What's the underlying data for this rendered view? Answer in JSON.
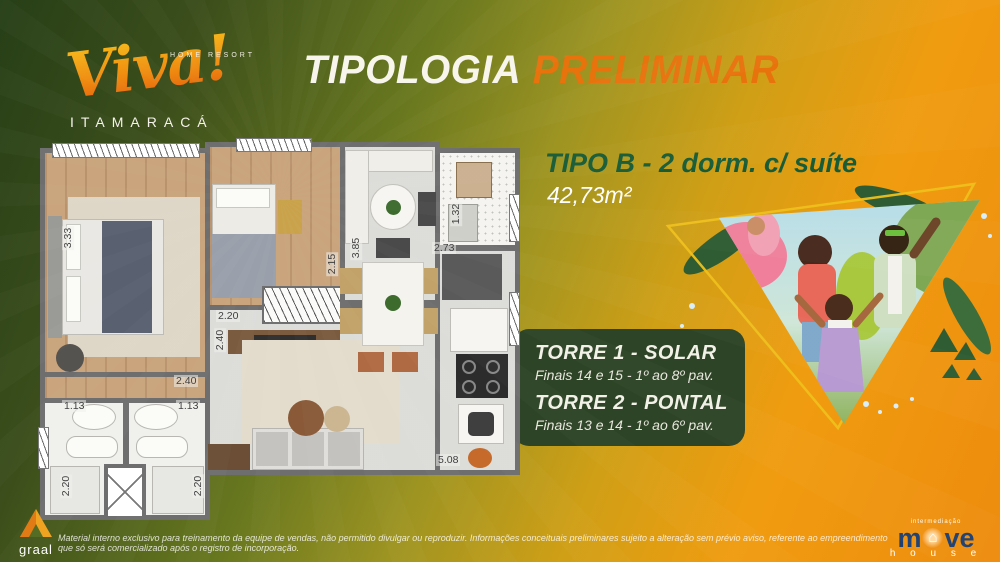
{
  "brand": {
    "script": "Viva!",
    "tagline": "HOME RESORT",
    "location": "ITAMARACÁ"
  },
  "header": {
    "title_white": "TIPOLOGIA",
    "title_orange": "PRELIMINAR"
  },
  "unit": {
    "name": "TIPO B - 2 dorm. c/ suíte",
    "area": "42,73m²"
  },
  "towers": [
    {
      "name": "TORRE 1 - SOLAR",
      "floors": "Finais 14 e 15 - 1º ao 8º pav."
    },
    {
      "name": "TORRE 2 - PONTAL",
      "floors": "Finais 13 e 14 - 1º ao 6º pav."
    }
  ],
  "floor_plan": {
    "dimensions": {
      "suite_length": "3.33",
      "suite_width": "2.40",
      "bed2_width": "2.20",
      "corridor_length": "2.40",
      "bath_left_width": "1.13",
      "bath_right_width": "1.13",
      "bath_left_length": "2.20",
      "bath_right_length": "2.20",
      "bed2_length": "2.15",
      "living_length": "3.85",
      "living_width": "2.73",
      "service_width": "1.32",
      "kitchen_length": "5.08"
    }
  },
  "footer": {
    "disclaimer": "Material interno exclusivo para treinamento da equipe de vendas, não permitido divulgar ou reproduzir. Informações conceituais preliminares sujeito a alteração sem prévio aviso, referente ao empreendimento que só será comercializado após o registro de incorporação.",
    "graal_label": "graal",
    "movehouse": {
      "tagline": "intermediação",
      "word_start": "m",
      "word_end": "ve",
      "word_sub": "h o u s e"
    }
  },
  "colors": {
    "accent_orange": "#e8720c",
    "unit_green": "#175c36",
    "torre_box_green": "#2e4426",
    "wall_gray": "#6e6e6e"
  }
}
